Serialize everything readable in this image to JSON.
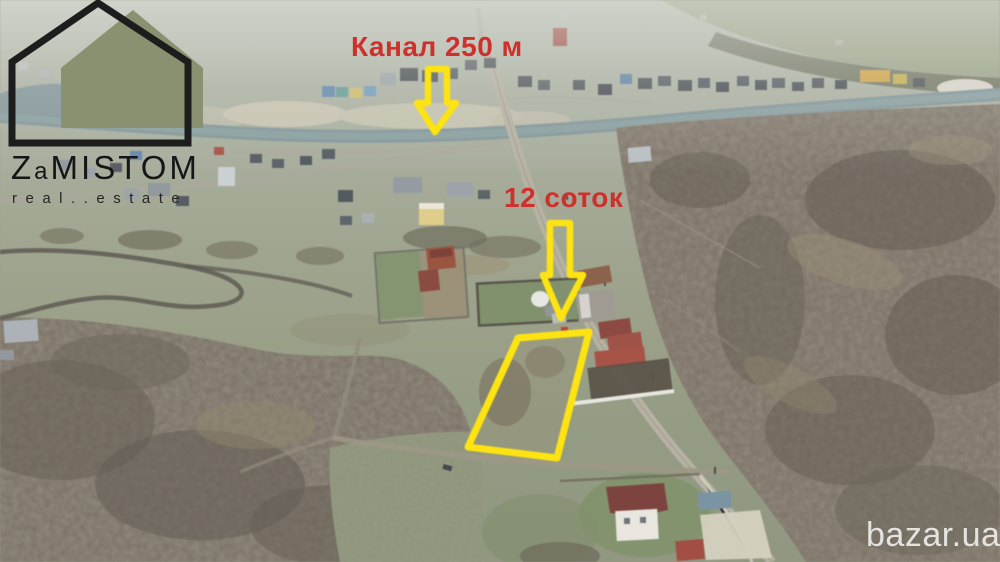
{
  "logo": {
    "brand_z": "Z",
    "brand_a": "a",
    "brand_rest": "MISTOM",
    "tagline": "real..estate",
    "house_fill": "#8a9170",
    "house_outline": "#1d1d1d"
  },
  "overlay": {
    "canal_label": "Канал 250 м",
    "area_label": "12 соток",
    "label_color": "#ce312d",
    "annotation_color": "#ffe400"
  },
  "watermark": {
    "text": "bazar.ua",
    "color": "#f0f0ed"
  }
}
